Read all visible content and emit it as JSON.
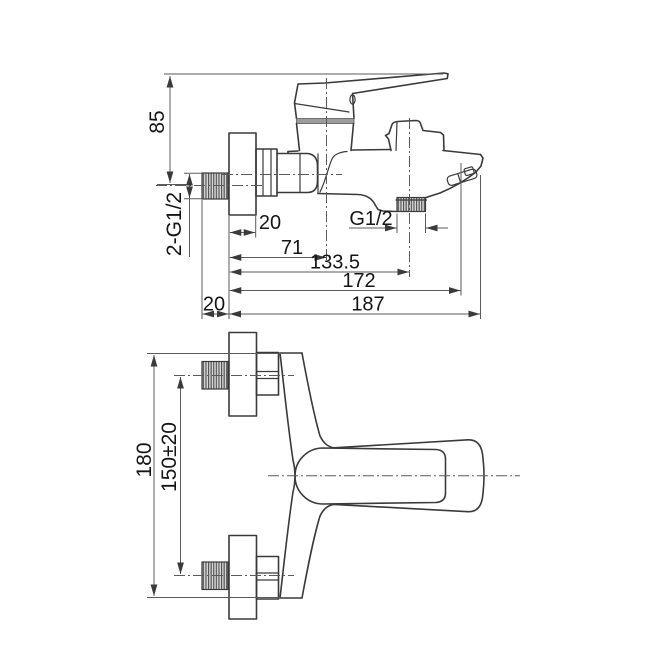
{
  "drawing": {
    "type": "bath-mixer-technical-drawing",
    "side_view": {
      "height_to_handle": "85",
      "inlet_thread_label": "2-G1/2",
      "flange_depth": "20",
      "outlet_thread_label": "G1/2",
      "wall_to_cartridge_axis": "71",
      "wall_to_outlet_axis": "133.5",
      "wall_to_aerator": "172",
      "total_length": "187",
      "thread_protrusion": "20"
    },
    "front_view": {
      "overall_height": "180",
      "hole_spacing": "150±20"
    },
    "colors": {
      "line": "#3a3a3a",
      "dimension": "#5a5a5a",
      "thread_fill": "#d6d6d6",
      "band": "#9c9c9c",
      "background": "#ffffff"
    }
  }
}
